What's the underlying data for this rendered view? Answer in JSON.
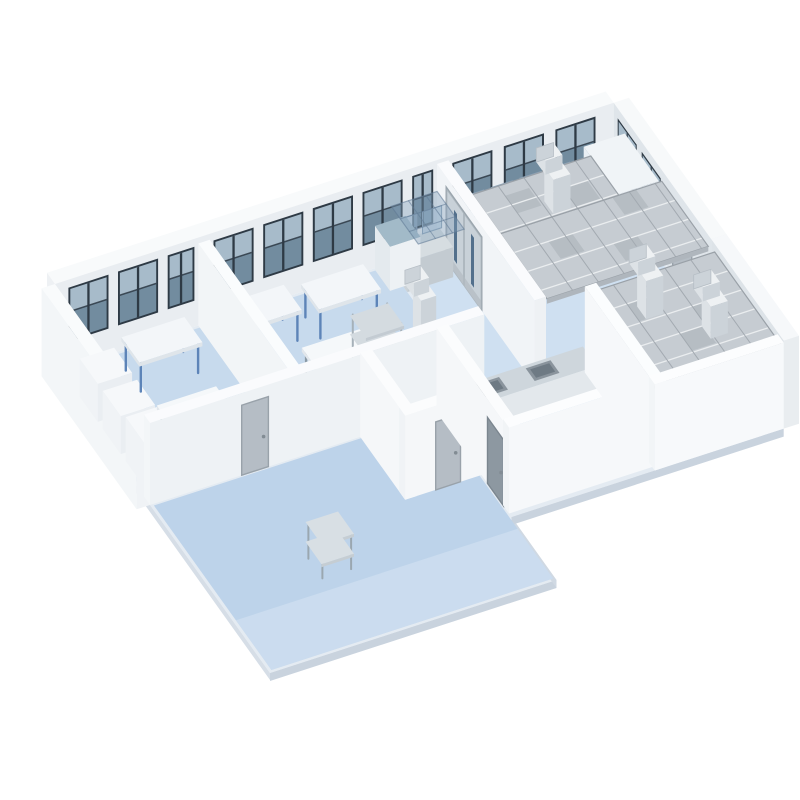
{
  "palette": {
    "background": "#ffffff",
    "floor_blue": "#bdd3ea",
    "floor_blue_light": "#cfe0f1",
    "wall_white": "#f2f5f7",
    "wall_shade": "#e9edf1",
    "window_frame": "#2e3a45",
    "window_glass": "#728c9f",
    "ceiling_grid": "#c6ccd2",
    "ahu_blue": "#4a7dc3",
    "steel": "#ccd4da",
    "door_gray": "#b5bdc5"
  },
  "scene": {
    "projection": {
      "ox": 55,
      "oy": 372,
      "ux": 0.955,
      "uy": -0.31,
      "vx": 0.5,
      "vy": 0.7
    },
    "items": [
      {
        "name": "ground-slab",
        "type": "floor",
        "pts": [
          [
            0,
            0
          ],
          [
            585,
            0
          ],
          [
            585,
            340
          ],
          [
            300,
            340
          ],
          [
            300,
            430
          ],
          [
            0,
            430
          ]
        ],
        "fill": "#e4ebf2"
      },
      {
        "name": "slab-edge-left",
        "type": "edge",
        "a": [
          0,
          0
        ],
        "b": [
          0,
          430
        ],
        "drop": 7,
        "fill": "#d6dee7"
      },
      {
        "name": "slab-edge-front-left",
        "type": "edge",
        "a": [
          0,
          430
        ],
        "b": [
          300,
          430
        ],
        "drop": 8,
        "fill": "#c9d3de"
      },
      {
        "name": "slab-edge-step",
        "type": "edge",
        "a": [
          300,
          430
        ],
        "b": [
          300,
          340
        ],
        "drop": 8,
        "fill": "#d0d9e3"
      },
      {
        "name": "slab-edge-front-right",
        "type": "edge",
        "a": [
          300,
          340
        ],
        "b": [
          585,
          340
        ],
        "drop": 8,
        "fill": "#c9d3de"
      },
      {
        "name": "lab-floor-left",
        "type": "floor",
        "pts": [
          [
            3,
            3
          ],
          [
            348,
            3
          ],
          [
            348,
            188
          ],
          [
            3,
            188
          ]
        ],
        "fill": "#c7daed"
      },
      {
        "name": "cleanroom-floor-back",
        "type": "floor",
        "pts": [
          [
            352,
            3
          ],
          [
            582,
            3
          ],
          [
            582,
            192
          ],
          [
            352,
            192
          ]
        ],
        "fill": "#cfe0f1"
      },
      {
        "name": "corridor-floor",
        "type": "floor",
        "pts": [
          [
            3,
            192
          ],
          [
            298,
            192
          ],
          [
            298,
            427
          ],
          [
            3,
            427
          ]
        ],
        "fill": "#bdd3ea"
      },
      {
        "name": "corridor-floor-sheen",
        "type": "floor",
        "pts": [
          [
            3,
            356
          ],
          [
            298,
            356
          ],
          [
            298,
            427
          ],
          [
            3,
            427
          ]
        ],
        "fill": "#d3e2f2",
        "opacity": 0.6
      },
      {
        "name": "kitchen-floor",
        "type": "floor",
        "pts": [
          [
            302,
            202
          ],
          [
            448,
            202
          ],
          [
            448,
            331
          ],
          [
            302,
            331
          ]
        ],
        "fill": "#c7daed"
      },
      {
        "name": "cleanroom-floor-front",
        "type": "floor",
        "pts": [
          [
            452,
            202
          ],
          [
            582,
            202
          ],
          [
            582,
            336
          ],
          [
            452,
            336
          ]
        ],
        "fill": "#c7daed"
      },
      {
        "name": "back-wall",
        "type": "box",
        "u0": 0,
        "u1": 585,
        "v0": -16,
        "v1": 0,
        "h0": 0,
        "h1": 88,
        "top": "#f8fafb",
        "front": "#e9edf1",
        "side": "#eef1f4"
      },
      {
        "name": "back-wall-window",
        "type": "winU",
        "v": 0,
        "h0": 26,
        "h1": 80,
        "frame": "#2e3a45",
        "glassLow": "#728c9f",
        "glassHigh": "#a7bbca",
        "pairs": [
          [
            14,
            56
          ],
          [
            66,
            108
          ],
          [
            118,
            146
          ],
          [
            166,
            208
          ],
          [
            218,
            260
          ],
          [
            270,
            312
          ],
          [
            322,
            364
          ],
          [
            374,
            396
          ],
          [
            416,
            458
          ],
          [
            470,
            512
          ],
          [
            524,
            566
          ]
        ]
      },
      {
        "name": "left-end-wall",
        "type": "box",
        "u0": -14,
        "u1": 0,
        "v0": 0,
        "v1": 190,
        "h0": 0,
        "h1": 88,
        "top": "#f9fbfc",
        "front": "#f0f3f6",
        "side": "#f3f6f8"
      },
      {
        "name": "right-end-wall",
        "type": "box",
        "u0": 585,
        "u1": 601,
        "v0": 0,
        "v1": 195,
        "h0": 0,
        "h1": 88,
        "top": "#f7f9fa",
        "front": "#e8edf0",
        "side": "#dfe5ea"
      },
      {
        "name": "right-wall-window",
        "type": "winV",
        "u": 585,
        "h0": 26,
        "h1": 78,
        "frame": "#2e3a45",
        "glassLow": "#728c9f",
        "glassHigh": "#a7bbca",
        "pairs": [
          [
            8,
            46
          ],
          [
            56,
            94
          ]
        ]
      },
      {
        "name": "door-right-wall",
        "type": "doorV",
        "u": 585,
        "v0": 118,
        "v1": 156,
        "h": 70,
        "fill": "#b5bdc5",
        "frame": "#99a2aa"
      },
      {
        "name": "workbench-back-right",
        "type": "box",
        "u0": 412,
        "u1": 575,
        "v0": 12,
        "v1": 40,
        "h0": 0,
        "h1": 30,
        "top": "#d6dde1",
        "front": "#c3cbd1",
        "side": "#ccd3d8"
      },
      {
        "name": "glass-screens-back",
        "type": "screens",
        "u0": 420,
        "n": 4,
        "gap": 30,
        "w": 22,
        "v": 13,
        "h0": 30,
        "h1": 54,
        "fill": "rgba(158,188,212,0.5)",
        "stroke": "#8aa2b8"
      },
      {
        "name": "air-handling-unit",
        "type": "box",
        "u0": 540,
        "u1": 583,
        "v0": 26,
        "v1": 94,
        "h0": 0,
        "h1": 76,
        "top": "#f0f4f7",
        "front": "#e2e8ee",
        "side": "#e9eff4"
      },
      {
        "name": "ahu-blue-panels",
        "type": "stripesV",
        "u": 540,
        "v0": 32,
        "h0": 5,
        "h1": 70,
        "n": 6,
        "w": 9,
        "gap": 1.5,
        "c1": "#4a7dc3",
        "c2": "#93b8e0"
      },
      {
        "name": "ceiling-grid-back-main",
        "type": "grid",
        "u0": 414,
        "u1": 583,
        "v0": 100,
        "v1": 193,
        "h": 80,
        "cell": 27,
        "fill": "#c6ccd2",
        "lineLight": "#eaedef",
        "lineDark": "#a3aab1",
        "border": "#9aa1a8",
        "beam": "#afb6bd",
        "darkTiles": [
          [
            450,
            127
          ],
          [
            504,
            154
          ],
          [
            531,
            100
          ]
        ]
      },
      {
        "name": "ceiling-grid-back-side",
        "type": "grid",
        "u0": 414,
        "u1": 538,
        "v0": 44,
        "v1": 100,
        "h": 80,
        "cell": 27,
        "fill": "#c6ccd2",
        "lineLight": "#eaedef",
        "lineDark": "#a3aab1",
        "border": "#9aa1a8",
        "beam": "none",
        "darkTiles": [
          [
            441,
            58
          ],
          [
            495,
            72
          ]
        ]
      },
      {
        "name": "hvac-duct-back",
        "type": "duct",
        "u": 480,
        "v": 88,
        "h0": 80,
        "h1": 114,
        "s": 18,
        "top": "#eef1f3",
        "front": "#ccd3d9",
        "side": "#dde2e6"
      },
      {
        "name": "partition-wall-cleanroom",
        "type": "box",
        "u0": 400,
        "u1": 412,
        "v0": 0,
        "v1": 195,
        "h0": 0,
        "h1": 84,
        "top": "#fafbfd",
        "front": "#eef1f4",
        "side": "#f1f4f7"
      },
      {
        "name": "steel-double-door",
        "type": "dblDoorV",
        "u": 400,
        "v0": 20,
        "v1": 88,
        "h": 72,
        "frame": "#9aa5ad",
        "panel": "#c8d1d8",
        "slit": "#53708c"
      },
      {
        "name": "workbench-anteroom",
        "type": "box",
        "u0": 348,
        "u1": 396,
        "v0": 12,
        "v1": 40,
        "h0": 0,
        "h1": 30,
        "top": "#d6dde1",
        "front": "#c3cbd1",
        "side": "#ccd3d8"
      },
      {
        "name": "glass-screens-ante",
        "type": "screens",
        "u0": 352,
        "n": 2,
        "gap": 26,
        "w": 20,
        "v": 13,
        "h0": 30,
        "h1": 52,
        "fill": "rgba(158,188,212,0.5)",
        "stroke": "#8aa2b8"
      },
      {
        "name": "pass-box",
        "type": "box",
        "u0": 334,
        "u1": 366,
        "v0": 2,
        "v1": 32,
        "h0": 0,
        "h1": 44,
        "top": "#a2bac8",
        "front": "#edf1f4",
        "side": "#e4eaee"
      },
      {
        "name": "glazed-canopy",
        "type": "canopy",
        "u0": 350,
        "u1": 398,
        "v0": 4,
        "v1": 58,
        "h": 60,
        "cell": 18,
        "fill": "rgba(130,158,185,0.38)",
        "line": "rgba(95,120,148,0.55)"
      },
      {
        "name": "lab-table-blue-1",
        "type": "table",
        "u0": 163,
        "u1": 228,
        "v0": 22,
        "v1": 58,
        "h": 32,
        "top": "#f3f6f9",
        "edge": "#dfe5ea",
        "leg": "#5d84b8"
      },
      {
        "name": "lab-table-blue-2",
        "type": "table",
        "u0": 243,
        "u1": 308,
        "v0": 28,
        "v1": 64,
        "h": 32,
        "top": "#f3f6f9",
        "edge": "#dfe5ea",
        "leg": "#5d84b8"
      },
      {
        "name": "lab-table-white",
        "type": "table",
        "u0": 205,
        "u1": 272,
        "v0": 102,
        "v1": 140,
        "h": 32,
        "top": "#f5f8fa",
        "edge": "#e2e7ec",
        "leg": "#8b9aa6"
      },
      {
        "name": "stainless-shelf-rack",
        "type": "shelf",
        "u0": 246,
        "u1": 286,
        "v0": 120,
        "v1": 152,
        "h": 66,
        "levels": 4,
        "post": "#a6b1b9",
        "top": "#d4dbe0",
        "front": "#c3cbd2"
      },
      {
        "name": "equipment-pedestal",
        "type": "box",
        "u0": 282,
        "u1": 314,
        "v0": 152,
        "v1": 186,
        "h0": 0,
        "h1": 56,
        "top": "#f4f7f9",
        "front": "#e8edf1",
        "side": "#eef2f5"
      },
      {
        "name": "hvac-duct-center",
        "type": "duct",
        "u": 298,
        "v": 170,
        "h0": 56,
        "h1": 106,
        "s": 16,
        "top": "#eef1f3",
        "front": "#ccd3d9",
        "side": "#dde2e6"
      },
      {
        "name": "partition-wall-left",
        "type": "box",
        "u0": 150,
        "u1": 162,
        "v0": 0,
        "v1": 190,
        "h0": 0,
        "h1": 82,
        "top": "#fafcfd",
        "front": "#eff2f5",
        "side": "#f2f5f7"
      },
      {
        "name": "cabinet-1",
        "type": "box",
        "u0": 6,
        "u1": 42,
        "v0": 38,
        "v1": 74,
        "h0": 0,
        "h1": 38,
        "top": "#f6f8fa",
        "front": "#eaeef2",
        "side": "#f0f3f6"
      },
      {
        "name": "cabinet-2",
        "type": "box",
        "u0": 6,
        "u1": 42,
        "v0": 84,
        "v1": 120,
        "h0": 0,
        "h1": 38,
        "top": "#f6f8fa",
        "front": "#eaeef2",
        "side": "#f0f3f6"
      },
      {
        "name": "cabinet-3",
        "type": "box",
        "u0": 6,
        "u1": 42,
        "v0": 130,
        "v1": 168,
        "h0": 0,
        "h1": 44,
        "top": "#f6f8fa",
        "front": "#eaeef2",
        "side": "#f0f3f6"
      },
      {
        "name": "lab-table-blue-3",
        "type": "table",
        "u0": 58,
        "u1": 124,
        "v0": 22,
        "v1": 58,
        "h": 32,
        "top": "#f3f6f9",
        "edge": "#dfe5ea",
        "leg": "#5d84b8"
      },
      {
        "name": "side-table-white",
        "type": "table",
        "u0": 48,
        "u1": 110,
        "v0": 112,
        "v1": 148,
        "h": 30,
        "top": "#f5f8fa",
        "edge": "#e2e7ec",
        "leg": "#8b9aa6"
      },
      {
        "name": "corridor-wall",
        "type": "box",
        "u0": 0,
        "u1": 350,
        "v0": 178,
        "v1": 190,
        "h0": 0,
        "h1": 82,
        "top": "#fafbfd",
        "front": "#eef2f5",
        "side": "#f3f6f8"
      },
      {
        "name": "door-corridor",
        "type": "doorU",
        "v": 190,
        "u0": 96,
        "u1": 124,
        "h": 70,
        "fill": "#b5bdc5",
        "frame": "#99a2aa"
      },
      {
        "name": "utility-wall-left",
        "type": "box",
        "u0": 220,
        "u1": 232,
        "v0": 190,
        "v1": 280,
        "h0": 0,
        "h1": 84,
        "top": "#fbfcfd",
        "front": "#f3f6f8",
        "side": "#f5f7f9"
      },
      {
        "name": "utility-wall-front",
        "type": "box",
        "u0": 220,
        "u1": 300,
        "v0": 268,
        "v1": 280,
        "h0": 0,
        "h1": 84,
        "top": "#fbfcfd",
        "front": "#f5f7f9",
        "side": "#f0f3f6"
      },
      {
        "name": "door-utility",
        "type": "doorU",
        "v": 280,
        "u0": 252,
        "u1": 278,
        "h": 68,
        "fill": "#b5bdc5",
        "frame": "#99a2aa"
      },
      {
        "name": "kitchen-counter",
        "type": "box",
        "u0": 314,
        "u1": 446,
        "v0": 204,
        "v1": 232,
        "h0": 0,
        "h1": 30,
        "top": "#ced6dc",
        "front": "#e3e8ec",
        "side": "#dae0e5"
      },
      {
        "name": "sink-basins",
        "type": "topInsets",
        "h": 30,
        "fill": "#8a949d",
        "inner": "#6e7a84",
        "rects": [
          [
            330,
            208,
            26,
            18
          ],
          [
            384,
            208,
            26,
            18
          ]
        ]
      },
      {
        "name": "kitchen-wall-left",
        "type": "box",
        "u0": 300,
        "u1": 312,
        "v0": 190,
        "v1": 335,
        "h0": 0,
        "h1": 84,
        "top": "#fbfcfd",
        "front": "#f2f5f7",
        "side": "#f5f7f9"
      },
      {
        "name": "kitchen-doorway",
        "type": "doorV",
        "u": 300,
        "v0": 292,
        "v1": 324,
        "h": 66,
        "fill": "#8d98a1",
        "frame": "#7b868f"
      },
      {
        "name": "kitchen-wall-front",
        "type": "box",
        "u0": 300,
        "u1": 450,
        "v0": 323,
        "v1": 335,
        "h0": 0,
        "h1": 86,
        "top": "#fcfdfe",
        "front": "#f6f8fa",
        "side": "#f1f4f6"
      },
      {
        "name": "cleanroom-wall-right",
        "type": "box",
        "u0": 585,
        "u1": 601,
        "v0": 195,
        "v1": 340,
        "h0": 0,
        "h1": 88,
        "top": "#f6f8fa",
        "front": "#e9edf0",
        "side": "#dde3e8"
      },
      {
        "name": "ceiling-grid-front",
        "type": "grid",
        "u0": 452,
        "u1": 585,
        "v0": 202,
        "v1": 338,
        "h": 80,
        "cell": 27,
        "fill": "#c6ccd2",
        "lineLight": "#eaedef",
        "lineDark": "#a3aab1",
        "border": "#9aa1a8",
        "beam": "#afb6bd",
        "darkTiles": [
          [
            479,
            229
          ],
          [
            506,
            283
          ],
          [
            533,
            256
          ]
        ]
      },
      {
        "name": "hvac-duct-front-1",
        "type": "duct",
        "u": 495,
        "v": 245,
        "h0": 80,
        "h1": 118,
        "s": 18,
        "top": "#eef1f3",
        "front": "#ccd3d9",
        "side": "#dde2e6"
      },
      {
        "name": "hvac-duct-front-2",
        "type": "duct",
        "u": 538,
        "v": 292,
        "h0": 80,
        "h1": 112,
        "s": 18,
        "top": "#eef1f3",
        "front": "#ccd3d9",
        "side": "#dde2e6"
      },
      {
        "name": "cleanroom-wall-entry",
        "type": "box",
        "u0": 450,
        "u1": 462,
        "v0": 200,
        "v1": 340,
        "h0": 0,
        "h1": 86,
        "top": "#fbfdfe",
        "front": "#f2f5f7",
        "side": "#f6f8fa"
      },
      {
        "name": "cleanroom-wall-front",
        "type": "box",
        "u0": 450,
        "u1": 585,
        "v0": 328,
        "v1": 340,
        "h0": 0,
        "h1": 86,
        "top": "#fcfdfe",
        "front": "#f7f9fb",
        "side": "#f2f5f7"
      },
      {
        "name": "utility-cart",
        "type": "cart",
        "u0": 100,
        "u1": 134,
        "v0": 310,
        "v1": 342,
        "h": 36,
        "post": "#9aa7b0",
        "top": "#d8dfe4",
        "front": "#c5cdd3"
      }
    ]
  }
}
